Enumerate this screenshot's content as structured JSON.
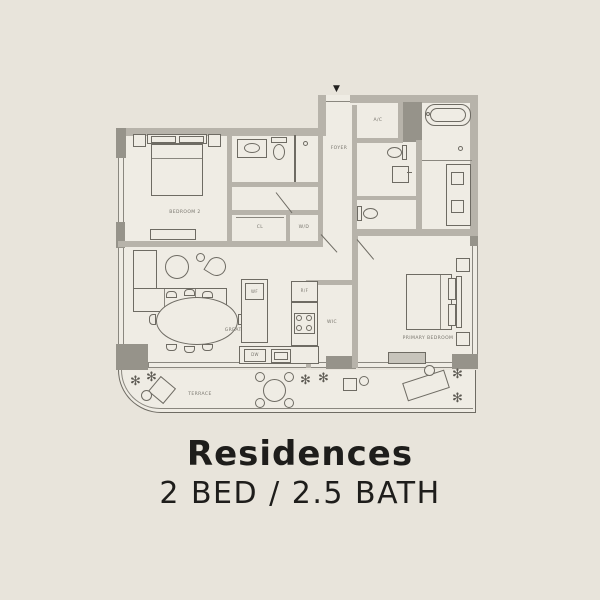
{
  "title": {
    "heading": "Residences",
    "subheading": "2 BED / 2.5 BATH"
  },
  "floorplan": {
    "labels": {
      "bedroom2": "BEDROOM 2",
      "closet": "CL",
      "washer_dryer": "W/D",
      "foyer": "FOYER",
      "ac": "A/C",
      "great_room": "GREAT ROOM",
      "wine_fridge": "WF",
      "fridge": "R/F",
      "dishwasher": "DW",
      "wic": "WIC",
      "primary_bedroom": "PRIMARY BEDROOM",
      "terrace": "TERRACE"
    },
    "icons": {
      "entry_marker": "▼",
      "plant": "✻"
    },
    "colors": {
      "page_background": "#e8e4db",
      "floor": "#efece4",
      "wall": "#b7b3aa",
      "column": "#96938a",
      "linework": "#6e6b63",
      "label_text": "#76736b",
      "title_text": "#1e1d1b"
    }
  }
}
